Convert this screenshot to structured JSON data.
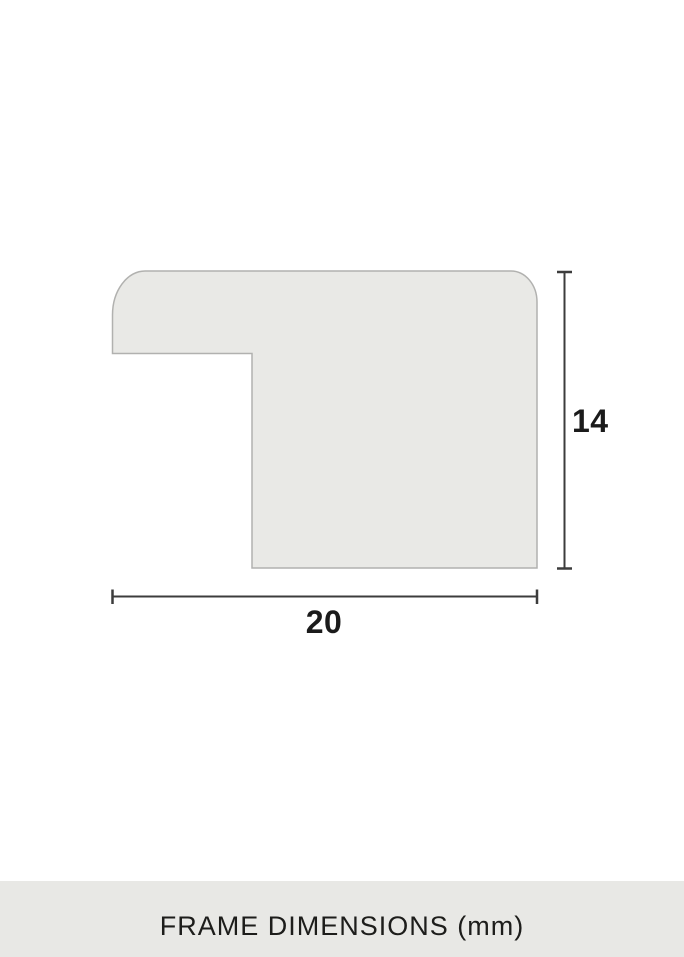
{
  "diagram": {
    "type": "frame-moulding-cross-section",
    "height_dimension": {
      "value": "14",
      "unit": "mm"
    },
    "width_dimension": {
      "value": "20",
      "unit": "mm"
    },
    "colors": {
      "shape_fill": "#e9e9e6",
      "shape_stroke": "#b1b1af",
      "dimension_line": "#3c3c3c",
      "label_text": "#1b1b1b"
    }
  },
  "footer": {
    "label": "FRAME DIMENSIONS (mm)",
    "background": "#e8e8e5",
    "text_color": "#1d1d1b"
  }
}
